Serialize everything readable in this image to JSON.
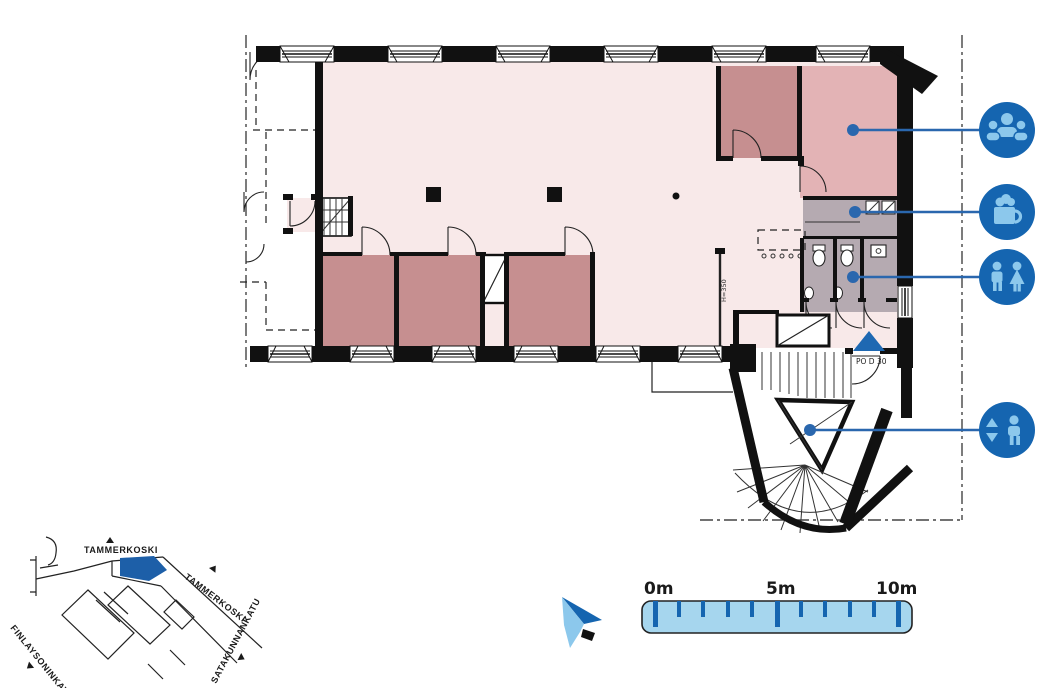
{
  "plan": {
    "entrance_label": "PO D 30",
    "height_label": "H=350",
    "markers": [
      {
        "name": "meeting-area",
        "icon": "people-group-icon"
      },
      {
        "name": "coffee-point",
        "icon": "coffee-cup-icon"
      },
      {
        "name": "restroom",
        "icon": "wc-figures-icon"
      },
      {
        "name": "elevator",
        "icon": "elevator-icon"
      }
    ]
  },
  "scale_bar": {
    "start_label": "0m",
    "mid_label": "5m",
    "end_label": "10m",
    "length_m": 10,
    "tick_count": 11
  },
  "minimap": {
    "street_top": "TAMMERKOSKI",
    "street_diag": "TAMMERKOSKI",
    "street_left": "FINLAYSONINKATU",
    "street_right": "SATAKUNNANKATU"
  },
  "colors": {
    "accent-blue": "#1565b0",
    "icon-glyph": "#8cc8ec",
    "leader-blue": "#2a67ae",
    "floor-light": "#f8e9e9",
    "room-dark": "#c68f90",
    "room-medium": "#e3b3b5",
    "service-mauve": "#b5aab1",
    "scale-fill": "#a6d6ee",
    "map-highlight": "#1d5fa8",
    "entrance-blue": "#1e68b2",
    "ink": "#111111"
  }
}
